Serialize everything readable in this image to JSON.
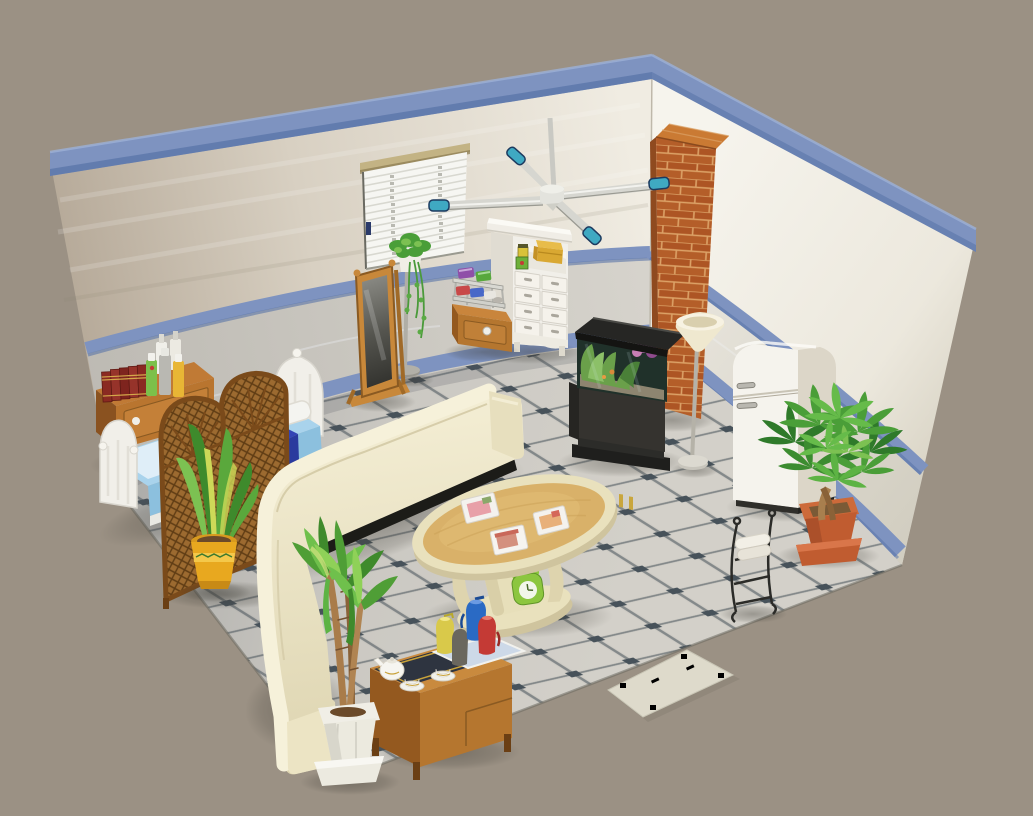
{
  "meta": {
    "app": "3D room decorator game view",
    "view": "isometric-room",
    "canvas_width": 1033,
    "canvas_height": 816
  },
  "palette": {
    "background": "#9b9184",
    "trimBlue": "#7e93c0",
    "trimBlueDark": "#5a74a8",
    "marbleLeft": "#c9c6bf",
    "marbleRight": "#e7e4db",
    "floorTile": "#cfccc5",
    "floorGrout": "#84898a",
    "floorDot": "#47525a",
    "brick": "#b45e29",
    "brickTop": "#ca7a33",
    "brickSide": "#8f4a1f",
    "sofaCream": "#ece5c7",
    "sofaBright": "#f6f1da",
    "tableWood": "#d9b169",
    "tableCream": "#e9e1bd",
    "cartWood": "#b5762f",
    "fridgeWhite": "#f5f3ed",
    "fridgeSide": "#dcd6c8",
    "aquariumDark": "#35332f",
    "bedSheet": "#a9d3ec",
    "bedBlanket": "#3344b5",
    "frameWhite": "#f1efe9",
    "potYellow": "#e8a81f",
    "potTerracotta": "#c05c30",
    "potWhite": "#eceadf",
    "plantGreen": "#4a9e38",
    "plantGreenDark": "#2f7a2a",
    "plantGreenLight": "#7cc152",
    "rattan": "#9c6a30",
    "fanBlade": "#d6d6d0",
    "fanTeal": "#3fa9c2",
    "lampCream": "#efe8cf",
    "mirrorWood": "#c8883a",
    "matCream": "#dedacb",
    "deskWood": "#b9752f",
    "bookRed": "#8a2a22"
  },
  "room": {
    "walls": "white plaster upper walls with blue top trim, blue chair rail and blue baseboard; gray marble lower sections",
    "floor": "light gray tiles set diagonally with dark square accents at intersections",
    "background": "plain taupe void around the room"
  },
  "objects": [
    {
      "id": "window-blinds",
      "label": "Window with white venetian blinds"
    },
    {
      "id": "white-dresser",
      "label": "White hutch dresser with 8 drawers, yellow box and jars on shelf"
    },
    {
      "id": "snack-cabinet",
      "label": "Wooden cabinet with chrome snack rack and colorful packages"
    },
    {
      "id": "ivy-stand",
      "label": "Tall plant stand with trailing ivy in white pot"
    },
    {
      "id": "cheval-mirror",
      "label": "Wooden standing cheval mirror"
    },
    {
      "id": "brick-pillar",
      "label": "Red brick chimney pillar"
    },
    {
      "id": "aquarium",
      "label": "Aquarium with plants on dark cabinet"
    },
    {
      "id": "torchiere-lamp",
      "label": "Torchiere floor lamp with cream shade"
    },
    {
      "id": "refrigerator",
      "label": "White retro refrigerator"
    },
    {
      "id": "money-tree",
      "label": "Money tree plant in terracotta pot"
    },
    {
      "id": "towel-rack",
      "label": "Black wrought-iron rack with white towels"
    },
    {
      "id": "ceiling-fan",
      "label": "Ceiling fan with silver blades and teal tips"
    },
    {
      "id": "book-cabinet",
      "label": "Wooden cabinet with red books and spray bottles"
    },
    {
      "id": "bed",
      "label": "White bed with light blue sheets and dark blue blanket"
    },
    {
      "id": "folding-screen",
      "label": "Two-panel rattan folding screen with arched tops"
    },
    {
      "id": "snake-plant",
      "label": "Snake plant in yellow pot"
    },
    {
      "id": "corner-sofa",
      "label": "Cream curved corner sofa"
    },
    {
      "id": "coffee-table",
      "label": "Oval wooden coffee table with magazines and green clock"
    },
    {
      "id": "tea-cart",
      "label": "Wooden tea cart with teapot, cups and thermos jugs"
    },
    {
      "id": "dracaena-plant",
      "label": "Dracaena palm in white pot"
    },
    {
      "id": "floor-mat",
      "label": "Cream doormat with green border pattern"
    }
  ]
}
